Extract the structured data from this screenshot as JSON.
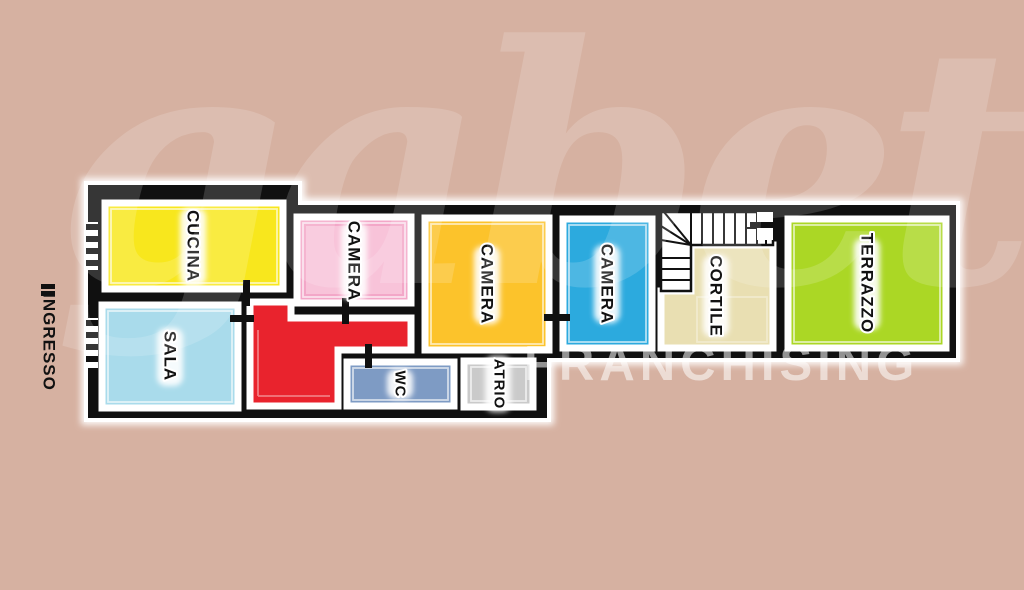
{
  "background_color": "#d6b1a1",
  "wall_color": "#101010",
  "watermark": {
    "brand": "gabetti",
    "subtitle": "FRANCHISING"
  },
  "floorplan": {
    "outside_label": "INGRESSO",
    "stair_color": "#ffffff",
    "rooms": [
      {
        "id": "cucina",
        "label": "CUCINA",
        "color": "#f8e71d"
      },
      {
        "id": "sala",
        "label": "SALA",
        "color": "#a9dbeb"
      },
      {
        "id": "camera-pink",
        "label": "CAMERA",
        "color": "#f3a7c8",
        "inner_color": "#f8c3d9"
      },
      {
        "id": "camera-orange",
        "label": "CAMERA",
        "color": "#fcc32b"
      },
      {
        "id": "camera-blue",
        "label": "CAMERA",
        "color": "#2caade"
      },
      {
        "id": "cortile",
        "label": "CORTILE",
        "color": "#e9dfb2"
      },
      {
        "id": "terrazzo",
        "label": "TERRAZZO",
        "color": "#abd725"
      },
      {
        "id": "wc",
        "label": "WC",
        "color": "#7e9bc4"
      },
      {
        "id": "atrio",
        "label": "ATRIO",
        "color": "#cacaca"
      },
      {
        "id": "corridor",
        "label": "",
        "color": "#e9232d"
      }
    ]
  }
}
